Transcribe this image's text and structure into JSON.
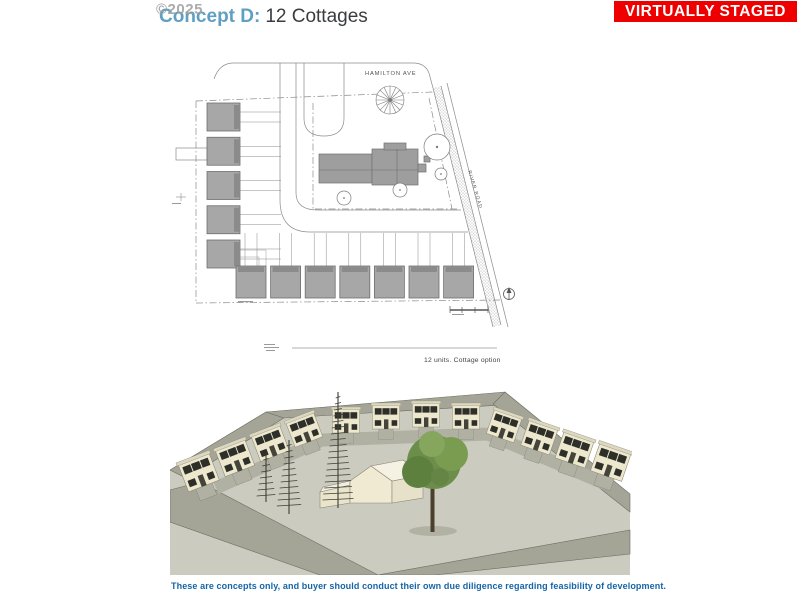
{
  "watermark": "©2025",
  "badge": {
    "label": "VIRTUALLY STAGED",
    "bg": "#ee0000",
    "fg": "#ffffff"
  },
  "title": {
    "prefix": "Concept D:",
    "main": "12 Cottages",
    "accent": "#5f9fc4",
    "text_color": "#3a3d40"
  },
  "site_plan": {
    "street_top": "HAMILTON AVE",
    "street_right": "RIVER ROAD",
    "caption": "12 units. Cottage option",
    "cottages_left": 5,
    "cottages_bottom": 7,
    "cottage_fill": "#a7a7a7"
  },
  "rendering": {
    "wings": {
      "left": 4,
      "back": 4,
      "right": 4
    },
    "colors": {
      "wall": "#ece7cd",
      "roofband": "#dcd8c0",
      "window": "#2f2f2a",
      "door": "#44443b",
      "ground": "#cbccbf",
      "road": "#a4a497",
      "path": "#b0b1a3",
      "tree_green": "#6d8e4b",
      "trunk": "#4c3f2c",
      "conifer": "#3c3e33"
    }
  },
  "disclaimer": {
    "text": "These are concepts only, and buyer should conduct their own due diligence regarding feasibility of development.",
    "color": "#1565a7"
  }
}
